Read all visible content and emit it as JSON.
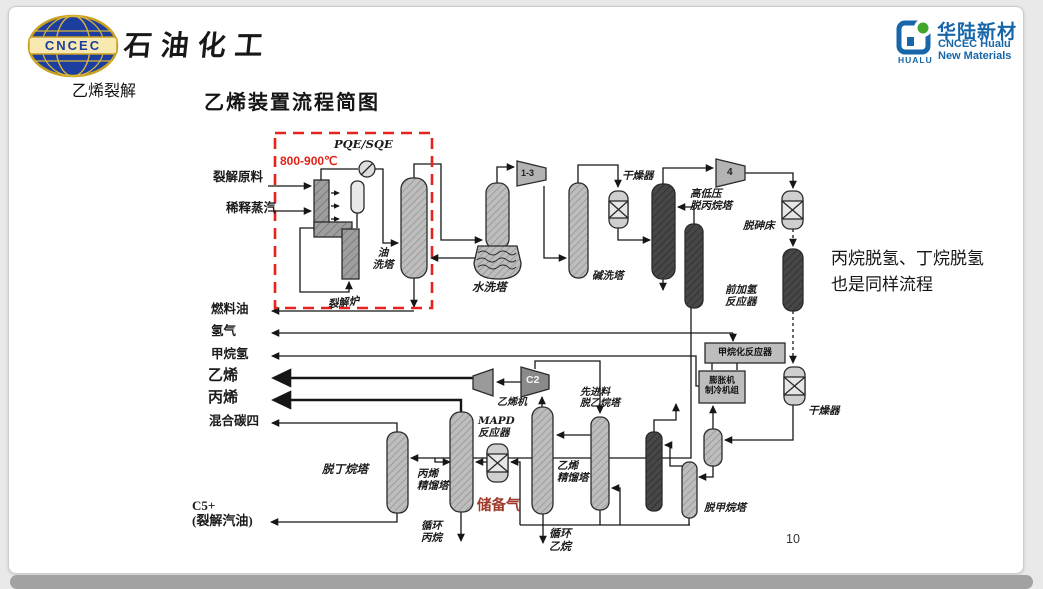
{
  "header": {
    "cncec_badge": "CNCEC",
    "brand": "石油化工",
    "hualu": {
      "glyph": "HUALU",
      "name": "华陆新材",
      "sub1": "CNCEC Hualu",
      "sub2": "New Materials"
    }
  },
  "slide": {
    "section_label": "乙烯裂解",
    "title": "乙烯装置流程简图",
    "side_note": "丙烷脱氢、丁烷脱氢\n也是同样流程",
    "page_number": "10"
  },
  "diagram": {
    "labels": [
      {
        "name": "feed-cracking",
        "text": "裂解原料"
      },
      {
        "name": "feed-steam",
        "text": "稀释蒸汽"
      },
      {
        "name": "temperature",
        "text": "800-900℃"
      },
      {
        "name": "pqe",
        "text": "PQE/SQE"
      },
      {
        "name": "oil-wash-tower",
        "text": "油\n洗塔"
      },
      {
        "name": "cracking-furnace",
        "text": "裂解炉"
      },
      {
        "name": "water-wash-tower",
        "text": "水洗塔"
      },
      {
        "name": "caustic-wash-tower",
        "text": "碱洗塔"
      },
      {
        "name": "dryer-left",
        "text": "干燥器"
      },
      {
        "name": "depropanizer",
        "text": "高低压\n脱丙烷塔"
      },
      {
        "name": "arsenic-removal-bed",
        "text": "脱砷床"
      },
      {
        "name": "front-hydrogenation",
        "text": "前加氢\n反应器"
      },
      {
        "name": "dryer-right",
        "text": "干燥器"
      },
      {
        "name": "fuel-oil",
        "text": "燃料油"
      },
      {
        "name": "hydrogen",
        "text": "氢气"
      },
      {
        "name": "methane-hydrogen",
        "text": "甲烷氢"
      },
      {
        "name": "ethylene",
        "text": "乙烯"
      },
      {
        "name": "propylene",
        "text": "丙烯"
      },
      {
        "name": "mixed-c4",
        "text": "混合碳四"
      },
      {
        "name": "ethylene-compressor",
        "text": "乙烯机"
      },
      {
        "name": "deethanizer",
        "text": "先进料\n脱乙烷塔"
      },
      {
        "name": "mapd-reactor",
        "text": "MAPD\n反应器"
      },
      {
        "name": "propylene-column",
        "text": "丙烯\n精馏塔"
      },
      {
        "name": "reserve-gas",
        "text": "储备气"
      },
      {
        "name": "recycle-propane",
        "text": "循环\n丙烷"
      },
      {
        "name": "ethylene-column",
        "text": "乙烯\n精馏塔"
      },
      {
        "name": "recycle-ethane",
        "text": "循环\n乙烷"
      },
      {
        "name": "demethanizer",
        "text": "脱甲烷塔"
      },
      {
        "name": "debutanizer",
        "text": "脱丁烷塔"
      },
      {
        "name": "c5-gasoline",
        "text": "C5+\n(裂解汽油)"
      },
      {
        "name": "compressor-1-3",
        "text": "1-3"
      },
      {
        "name": "compressor-4",
        "text": "4"
      },
      {
        "name": "compressor-c2",
        "text": "C2"
      },
      {
        "name": "methanation-reactor",
        "text": "甲烷化反应器"
      },
      {
        "name": "expander-unit",
        "text": "膨胀机\n制冷机组"
      }
    ]
  },
  "colors": {
    "accent_red": "#e8231d",
    "reserve_gas_red": "#a0392b",
    "brand_blue": "#1766a9",
    "logo_blue": "#1d3e9e",
    "logo_gold": "#c8a020"
  }
}
